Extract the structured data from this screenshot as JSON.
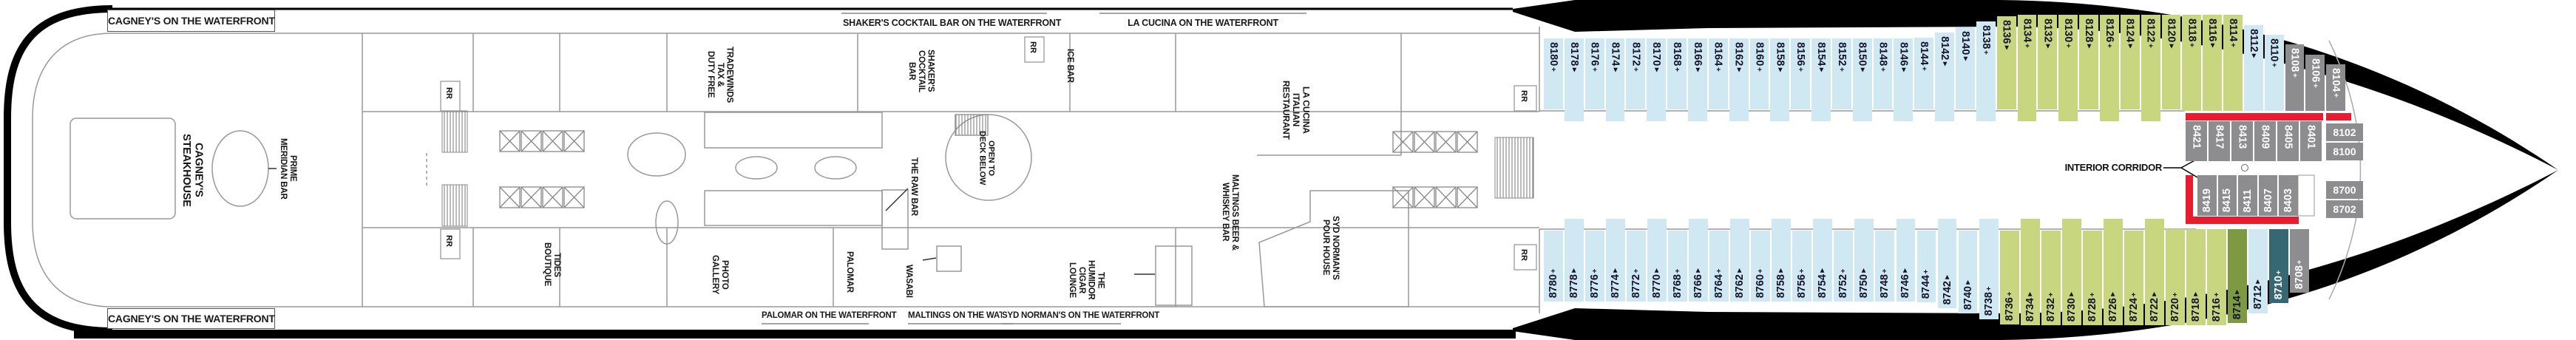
{
  "deck_plan": {
    "waterfront_banners": {
      "top": [
        "CAGNEY'S ON THE WATERFRONT",
        "SHAKER'S COCKTAIL BAR ON THE WATERFRONT",
        "LA CUCINA ON THE WATERFRONT"
      ],
      "bottom": [
        "CAGNEY'S ON THE WATERFRONT",
        "PALOMAR ON THE WATERFRONT",
        "MALTINGS ON THE WATERFRONT",
        "SYD NORMAN'S ON THE WATERFRONT"
      ]
    },
    "venues": {
      "cagneys_steakhouse": "CAGNEY'S STEAKHOUSE",
      "prime_meridian_bar": "PRIME\nMERIDIAN BAR",
      "tides_boutique": "TIDES\nBOUTIQUE",
      "tradewinds": "TRADEWINDS\nTAX &\nDUTY FREE",
      "photo_gallery": "PHOTO\nGALLERY",
      "shakers_cocktail_bar": "SHAKER'S\nCOCKTAIL\nBAR",
      "palomar": "PALOMAR",
      "the_raw_bar": "THE RAW BAR",
      "wasabi": "WASABI",
      "ice_bar": "ICE BAR",
      "open_to_deck_below": "OPEN TO\nDECK BELOW",
      "humidor_cigar_lounge": "THE\nHUMIDOR\nCIGAR LOUNGE",
      "maltings_beer_whiskey_bar": "MALTINGS BEER &\nWHISKEY BAR",
      "la_cucina_restaurant": "LA CUCINA\nITALIAN\nRESTAURANT",
      "syd_normans_pour_house": "SYD NORMAN'S\nPOUR HOUSE",
      "restroom": "RR",
      "interior_corridor": "INTERIOR CORRIDOR"
    },
    "cabins": {
      "port_row": [
        {
          "n": "8180",
          "s": "+",
          "c": "blue"
        },
        {
          "n": "8178",
          "s": "▲",
          "c": "blue"
        },
        {
          "n": "8176",
          "s": "+",
          "c": "blue"
        },
        {
          "n": "8174",
          "s": "▲",
          "c": "blue"
        },
        {
          "n": "8172",
          "s": "+",
          "c": "blue"
        },
        {
          "n": "8170",
          "s": "▲",
          "c": "blue"
        },
        {
          "n": "8168",
          "s": "+",
          "c": "blue"
        },
        {
          "n": "8166",
          "s": "▲",
          "c": "blue"
        },
        {
          "n": "8164",
          "s": "+",
          "c": "blue"
        },
        {
          "n": "8162",
          "s": "▲",
          "c": "blue"
        },
        {
          "n": "8160",
          "s": "+",
          "c": "blue"
        },
        {
          "n": "8158",
          "s": "▲",
          "c": "blue"
        },
        {
          "n": "8156",
          "s": "+",
          "c": "blue"
        },
        {
          "n": "8154",
          "s": "▲",
          "c": "blue"
        },
        {
          "n": "8152",
          "s": "+",
          "c": "blue"
        },
        {
          "n": "8150",
          "s": "▲",
          "c": "blue"
        },
        {
          "n": "8148",
          "s": "+",
          "c": "blue"
        },
        {
          "n": "8146",
          "s": "▲",
          "c": "blue"
        },
        {
          "n": "8144",
          "s": "+",
          "c": "blue"
        },
        {
          "n": "8142",
          "s": "▲",
          "c": "blue"
        },
        {
          "n": "8140",
          "s": "▲",
          "c": "blue"
        },
        {
          "n": "8138",
          "s": "+",
          "c": "blue"
        },
        {
          "n": "8136",
          "s": "▲",
          "c": "green"
        },
        {
          "n": "8134",
          "s": "+",
          "c": "green"
        },
        {
          "n": "8132",
          "s": "▲",
          "c": "green"
        },
        {
          "n": "8130",
          "s": "+",
          "c": "green"
        },
        {
          "n": "8128",
          "s": "▲",
          "c": "green"
        },
        {
          "n": "8126",
          "s": "+",
          "c": "green"
        },
        {
          "n": "8124",
          "s": "▲",
          "c": "green"
        },
        {
          "n": "8122",
          "s": "+",
          "c": "green"
        },
        {
          "n": "8120",
          "s": "▲",
          "c": "green"
        },
        {
          "n": "8118",
          "s": "+",
          "c": "green"
        },
        {
          "n": "8116",
          "s": "▲",
          "c": "green"
        },
        {
          "n": "8114",
          "s": "+",
          "c": "green"
        },
        {
          "n": "8112",
          "s": "▲",
          "c": "blue"
        },
        {
          "n": "8110",
          "s": "+",
          "c": "blue"
        },
        {
          "n": "8108",
          "s": "+",
          "c": "gray"
        },
        {
          "n": "8106",
          "s": "+",
          "c": "gray"
        },
        {
          "n": "8104",
          "s": "+",
          "c": "gray"
        }
      ],
      "starboard_row": [
        {
          "n": "8780",
          "s": "+",
          "c": "blue"
        },
        {
          "n": "8778",
          "s": "▲",
          "c": "blue"
        },
        {
          "n": "8776",
          "s": "+",
          "c": "blue"
        },
        {
          "n": "8774",
          "s": "▲",
          "c": "blue"
        },
        {
          "n": "8772",
          "s": "+",
          "c": "blue"
        },
        {
          "n": "8770",
          "s": "▲",
          "c": "blue"
        },
        {
          "n": "8768",
          "s": "+",
          "c": "blue"
        },
        {
          "n": "8766",
          "s": "▲",
          "c": "blue"
        },
        {
          "n": "8764",
          "s": "+",
          "c": "blue"
        },
        {
          "n": "8762",
          "s": "▲",
          "c": "blue"
        },
        {
          "n": "8760",
          "s": "+",
          "c": "blue"
        },
        {
          "n": "8758",
          "s": "▲",
          "c": "blue"
        },
        {
          "n": "8756",
          "s": "+",
          "c": "blue"
        },
        {
          "n": "8754",
          "s": "▲",
          "c": "blue"
        },
        {
          "n": "8752",
          "s": "+",
          "c": "blue"
        },
        {
          "n": "8750",
          "s": "▲",
          "c": "blue"
        },
        {
          "n": "8748",
          "s": "+",
          "c": "blue"
        },
        {
          "n": "8746",
          "s": "▲",
          "c": "blue"
        },
        {
          "n": "8744",
          "s": "+",
          "c": "blue"
        },
        {
          "n": "8742",
          "s": "▲",
          "c": "blue"
        },
        {
          "n": "8740",
          "s": "▲",
          "c": "blue"
        },
        {
          "n": "8738",
          "s": "+",
          "c": "blue"
        },
        {
          "n": "8736",
          "s": "+",
          "c": "green"
        },
        {
          "n": "8734",
          "s": "▲",
          "c": "green"
        },
        {
          "n": "8732",
          "s": "+",
          "c": "green"
        },
        {
          "n": "8730",
          "s": "▲",
          "c": "green"
        },
        {
          "n": "8728",
          "s": "+",
          "c": "green"
        },
        {
          "n": "8726",
          "s": "▲",
          "c": "green"
        },
        {
          "n": "8724",
          "s": "+",
          "c": "green"
        },
        {
          "n": "8722",
          "s": "▲",
          "c": "green"
        },
        {
          "n": "8720",
          "s": "+",
          "c": "green"
        },
        {
          "n": "8718",
          "s": "▲",
          "c": "green"
        },
        {
          "n": "8716",
          "s": "+",
          "c": "green"
        },
        {
          "n": "8714",
          "s": "▲",
          "c": "dgreen"
        },
        {
          "n": "8712",
          "s": "▲",
          "c": "blue"
        },
        {
          "n": "8710",
          "s": "+",
          "c": "teal"
        },
        {
          "n": "8708",
          "s": "+",
          "c": "gray"
        }
      ],
      "interior_fwd_port": [
        "8421",
        "8417",
        "8413",
        "8409",
        "8405",
        "8401"
      ],
      "interior_fwd_starboard": [
        "8419",
        "8415",
        "8411",
        "8407",
        "8403"
      ],
      "bow_interior": [
        "8102",
        "8100",
        "8700",
        "8702"
      ]
    },
    "colors": {
      "balcony_blue": "#cfe8f1",
      "balcony_green": "#c8d77f",
      "dark_green": "#7d9a42",
      "teal": "#356872",
      "interior_gray": "#8d8d8f",
      "corridor_red": "#e81c2e"
    }
  }
}
